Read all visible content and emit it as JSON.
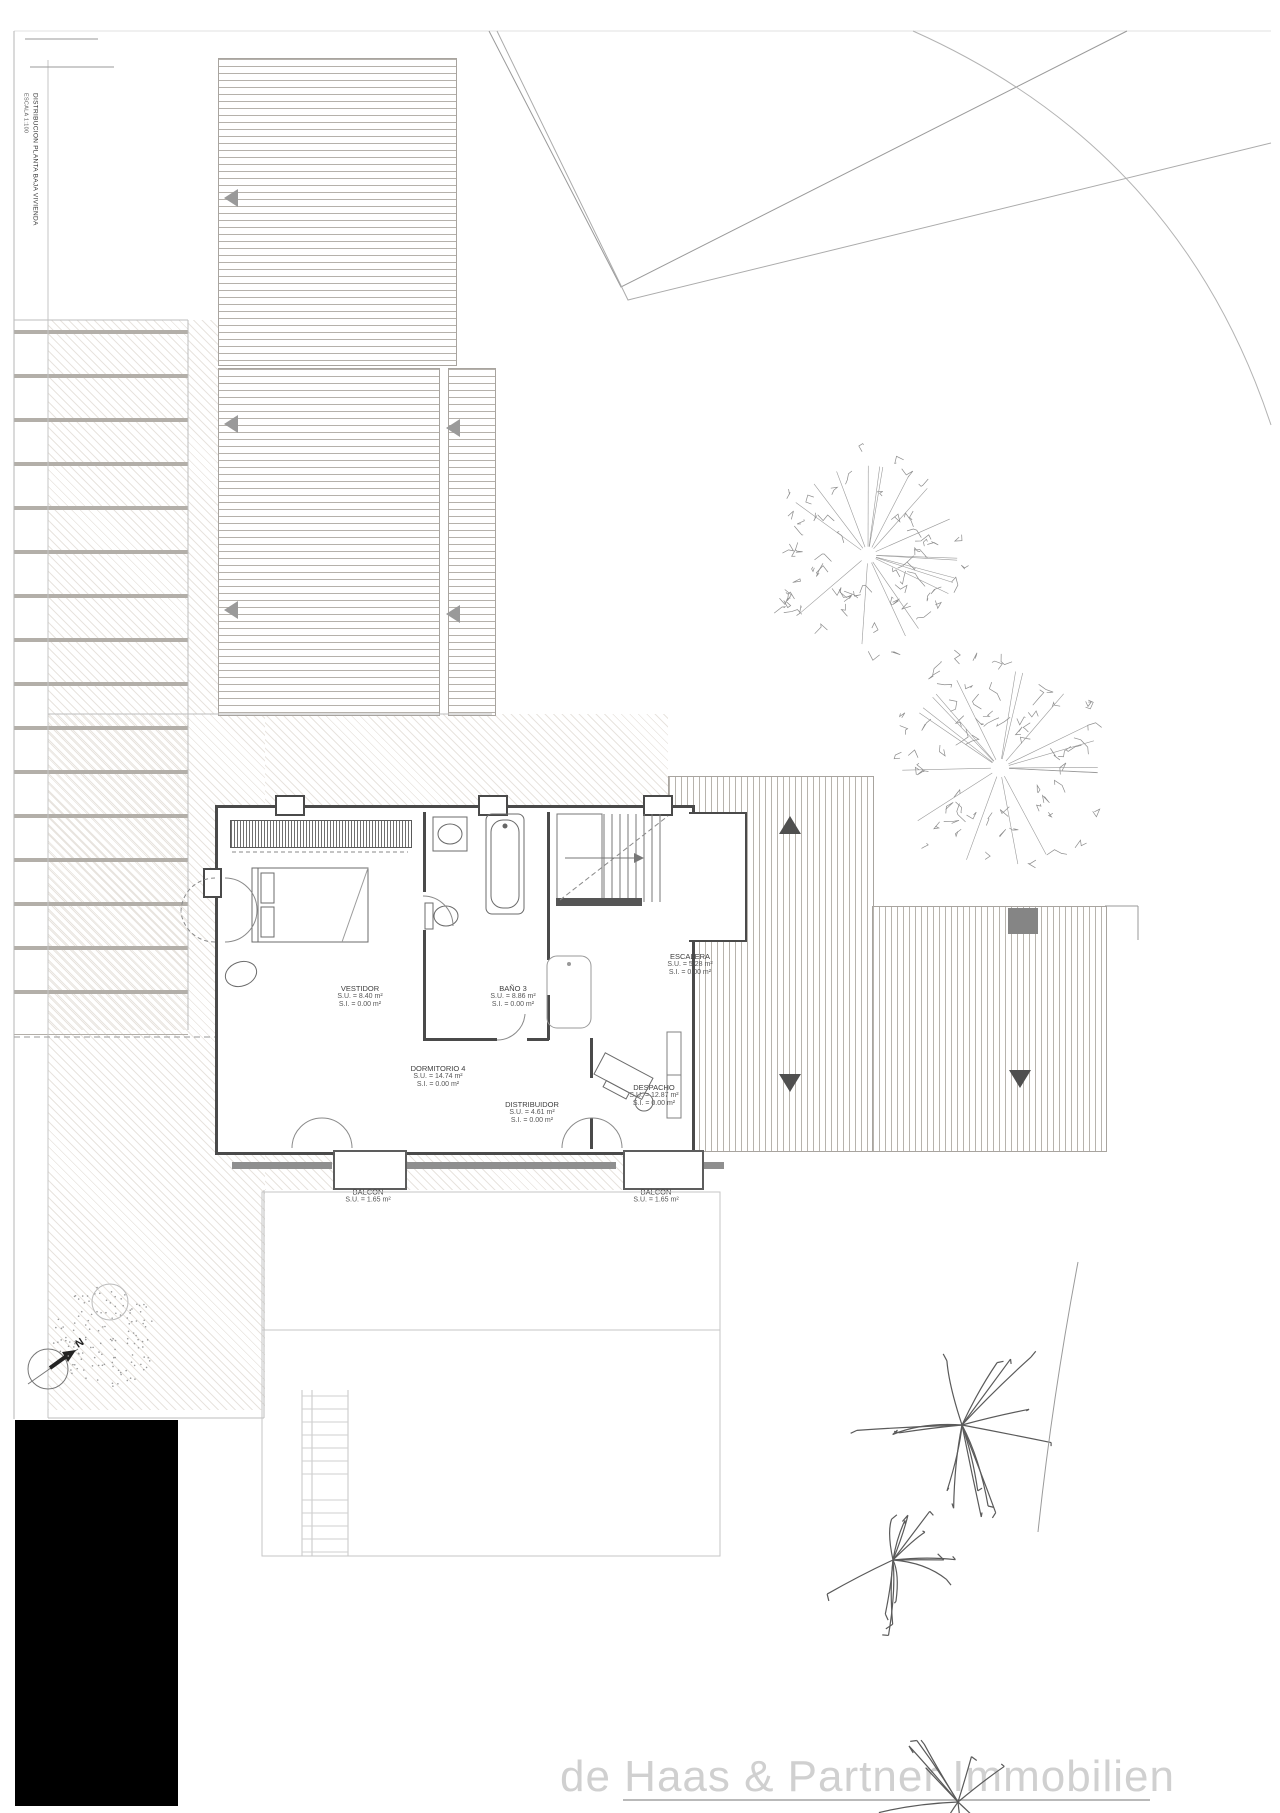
{
  "sheet": {
    "title_vertical": "DISTRIBUCION PLANTA BAJA VIVIENDA",
    "scale_note": "ESCALA 1:100",
    "watermark": "de Haas & Partner Immobilien",
    "north_label": "N"
  },
  "rooms": [
    {
      "name": "VESTIDOR",
      "su": "S.U. = 8.40 m²",
      "si": "S.I. = 0.00 m²"
    },
    {
      "name": "DORMITORIO 4",
      "su": "S.U. = 14.74 m²",
      "si": "S.I. = 0.00 m²"
    },
    {
      "name": "BAÑO 3",
      "su": "S.U. = 8.86 m²",
      "si": "S.I. = 0.00 m²"
    },
    {
      "name": "ESCALERA",
      "su": "S.U. = 5.28 m²",
      "si": "S.I. = 0.00 m²"
    },
    {
      "name": "DISTRIBUIDOR",
      "su": "S.U. = 4.61 m²",
      "si": "S.I. = 0.00 m²"
    },
    {
      "name": "DESPACHO",
      "su": "S.U. = 12.87 m²",
      "si": "S.I. = 0.00 m²"
    },
    {
      "name": "BALCON",
      "su": "S.U. = 1.65 m²"
    },
    {
      "name": "BALCON",
      "su": "S.U. = 1.65 m²"
    }
  ],
  "colors": {
    "wall": "#4a4a4a",
    "roof_line": "#b5b1ab",
    "hatch_line": "#bdae9e",
    "watermark": "#d0d0d0",
    "boundary": "#9a9a9a"
  }
}
